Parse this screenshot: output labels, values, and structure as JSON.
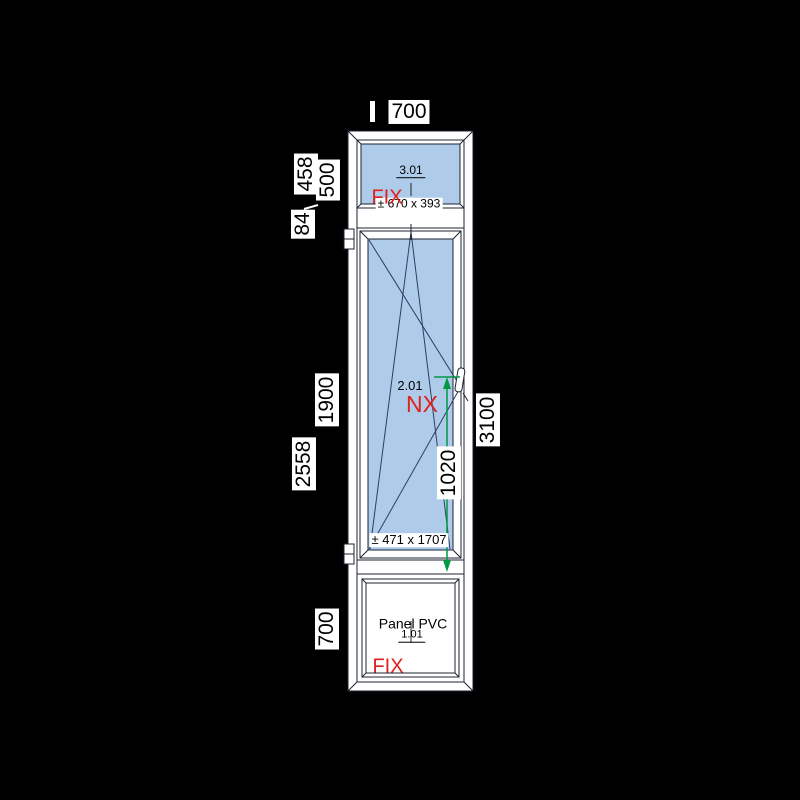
{
  "colors": {
    "background": "#000000",
    "frame": "#ffffff",
    "outline": "#1c2330",
    "glass": "#aecbea",
    "open_line": "#2e3d63",
    "accent_red": "#e0201d",
    "accent_green": "#009a44",
    "label_bg": "#ffffff",
    "label_text": "#000000"
  },
  "dimensions": {
    "top_width": "700",
    "left_outer_top": "458",
    "left_inner_top": "500",
    "left_outer_mid": "84",
    "left_inner_mid": "1900",
    "left_outer_bottom": "2558",
    "left_inner_bottom": "700",
    "right_total_height": "3100",
    "handle_height": "1020"
  },
  "sections": {
    "top_window": {
      "code": "3.01",
      "opening": "FIX",
      "size": "± 670 x 393"
    },
    "middle_window": {
      "code": "2.01",
      "opening": "NX",
      "size": "± 471 x 1707"
    },
    "bottom_panel": {
      "code": "1.01",
      "opening": "FIX",
      "material": "Panel PVC"
    }
  }
}
